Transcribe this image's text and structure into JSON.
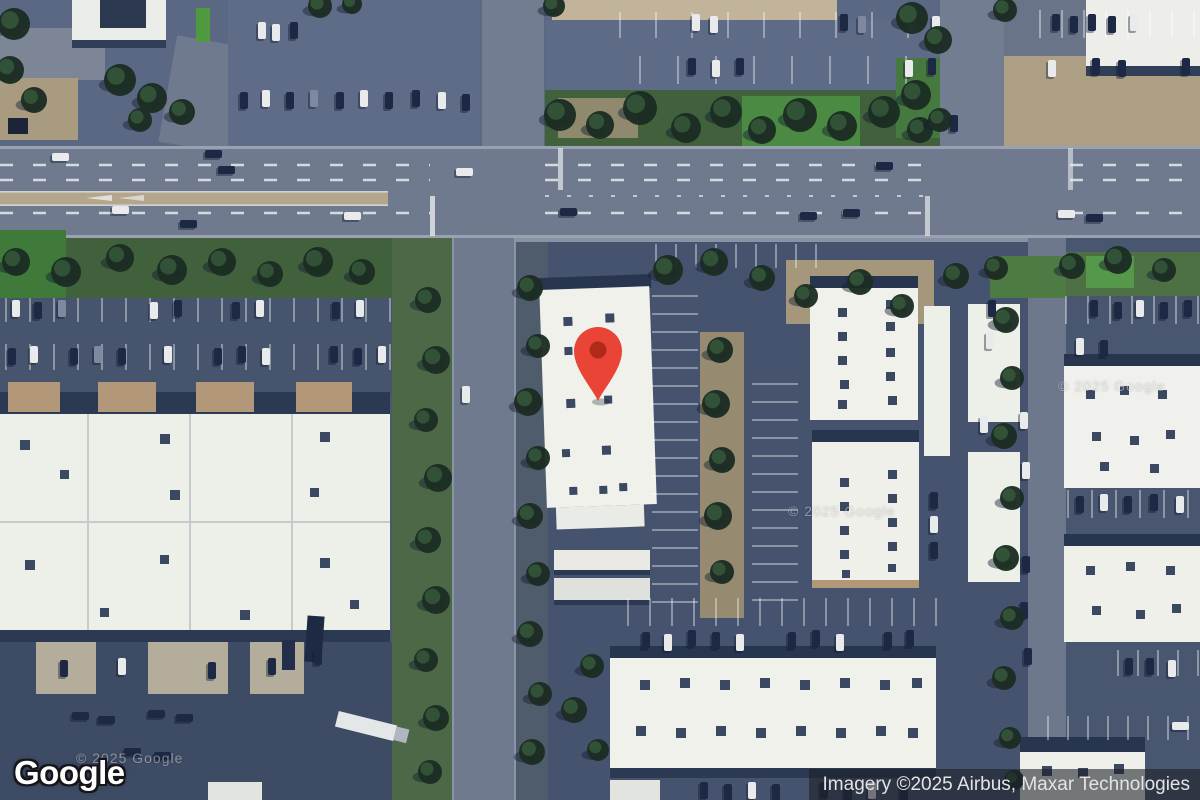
{
  "branding": {
    "logo_text": "Google"
  },
  "attribution": {
    "text": "Imagery ©2025 Airbus, Maxar Technologies"
  },
  "watermark": {
    "text": "© 2025 Google"
  },
  "marker": {
    "outer_color": "#E94436",
    "inner_color": "#B02A1C"
  },
  "map": {
    "type": "satellite-imagery",
    "palette": {
      "asphalt": "#4A5870",
      "road": "#6F7A8E",
      "roof_white": "#F0F1EB",
      "grass": "#41603C",
      "tree": "#1C2D23",
      "dirt": "#AC9F84"
    }
  }
}
